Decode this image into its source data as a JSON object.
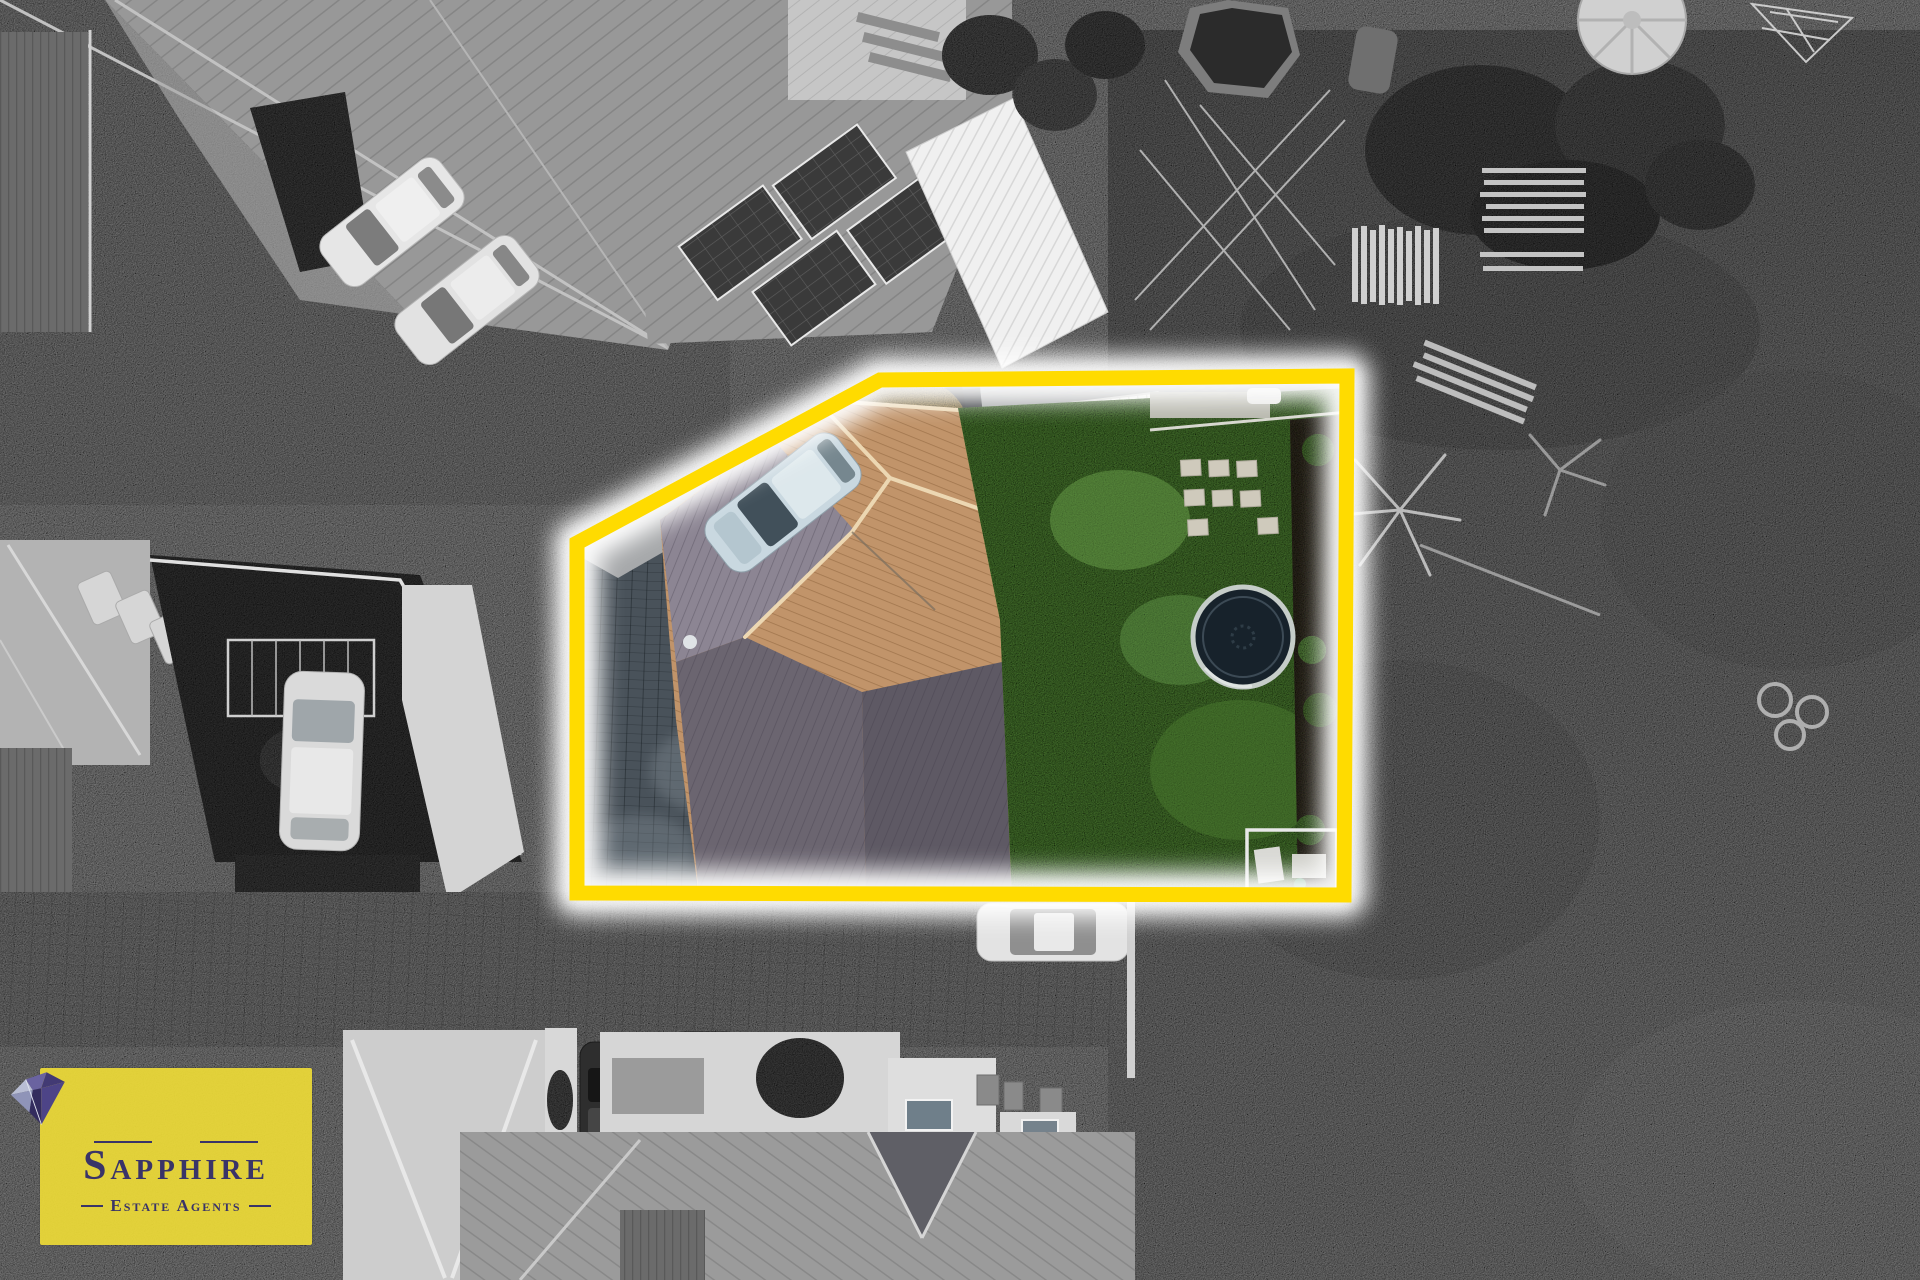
{
  "image": {
    "kind": "aerial-drone-photograph",
    "effect": "selective-color: highlighted lot in colour, surroundings in greyscale",
    "width_px": 1920,
    "height_px": 1280
  },
  "branding": {
    "agency_name": "Sapphire",
    "agency_tagline": "Estate Agents",
    "panel_color": "rgba(236,217,55,0.93)",
    "text_color": "#3a3468",
    "rule_color": "#3a3468"
  },
  "boundary": {
    "points": "880,380 1347,376 1344,895 577,893 577,543",
    "stroke_color": "#ffdb00",
    "glow_color": "#ffffff",
    "stroke_width": "15"
  },
  "lot": {
    "lawn_color": "#568c39",
    "roof_color": "#c1946a",
    "driveway_color": "#49525a",
    "shed_color": "#f0f0ee",
    "tree_color": "#c3a35e",
    "bin_colors": {
      "red": "#c23b2a",
      "yellow": "#e8a61c",
      "green": "#2aa05a"
    },
    "car_color": "#c9d8e0",
    "trampoline_mat": "#17222b",
    "trampoline_ring": "#c6cdc9"
  }
}
